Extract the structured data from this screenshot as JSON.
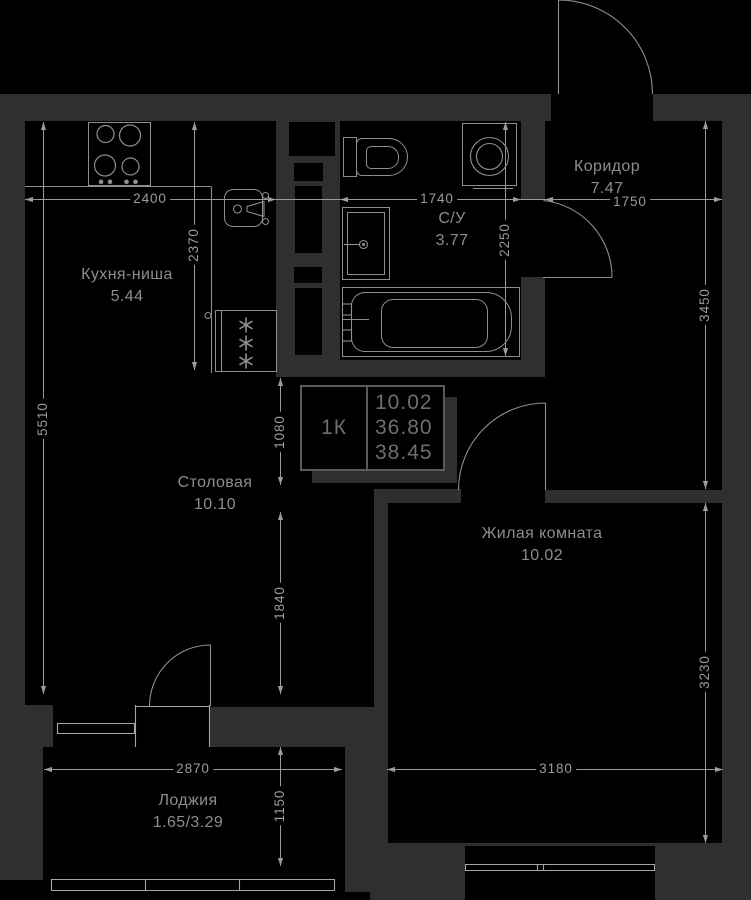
{
  "title": "Floor plan — 1K apartment",
  "rooms": {
    "kitchen": {
      "name": "Кухня-ниша",
      "area": "5.44"
    },
    "corridor": {
      "name": "Коридор",
      "area": "7.47"
    },
    "bathroom": {
      "name": "С/У",
      "area": "3.77"
    },
    "dining": {
      "name": "Столовая",
      "area": "10.10"
    },
    "living": {
      "name": "Жилая комната",
      "area": "10.02"
    },
    "loggia": {
      "name": "Лоджия",
      "area": "1.65/3.29"
    }
  },
  "info_table": {
    "type": "1К",
    "living_area": "10.02",
    "area": "36.80",
    "total_area": "38.45"
  },
  "dims": {
    "kitchen_w": "2400",
    "kitchen_d": "2370",
    "left_h": "5510",
    "bath_w": "1740",
    "corridor_w": "1750",
    "bath_h": "2250",
    "corridor_h": "3450",
    "hall_h": "1080",
    "dining_h": "1840",
    "living_h": "3230",
    "loggia_w": "2870",
    "living_w": "3180",
    "loggia_h": "1150"
  },
  "colors": {
    "background": "#000000",
    "wall": "#2f2f2f",
    "fixture_line": "#8f8f8f",
    "dim_line": "#9b9b9b",
    "label_text": "#8d8d8d",
    "table_text": "#6e6e6e",
    "table_border": "#5a5a5a"
  }
}
